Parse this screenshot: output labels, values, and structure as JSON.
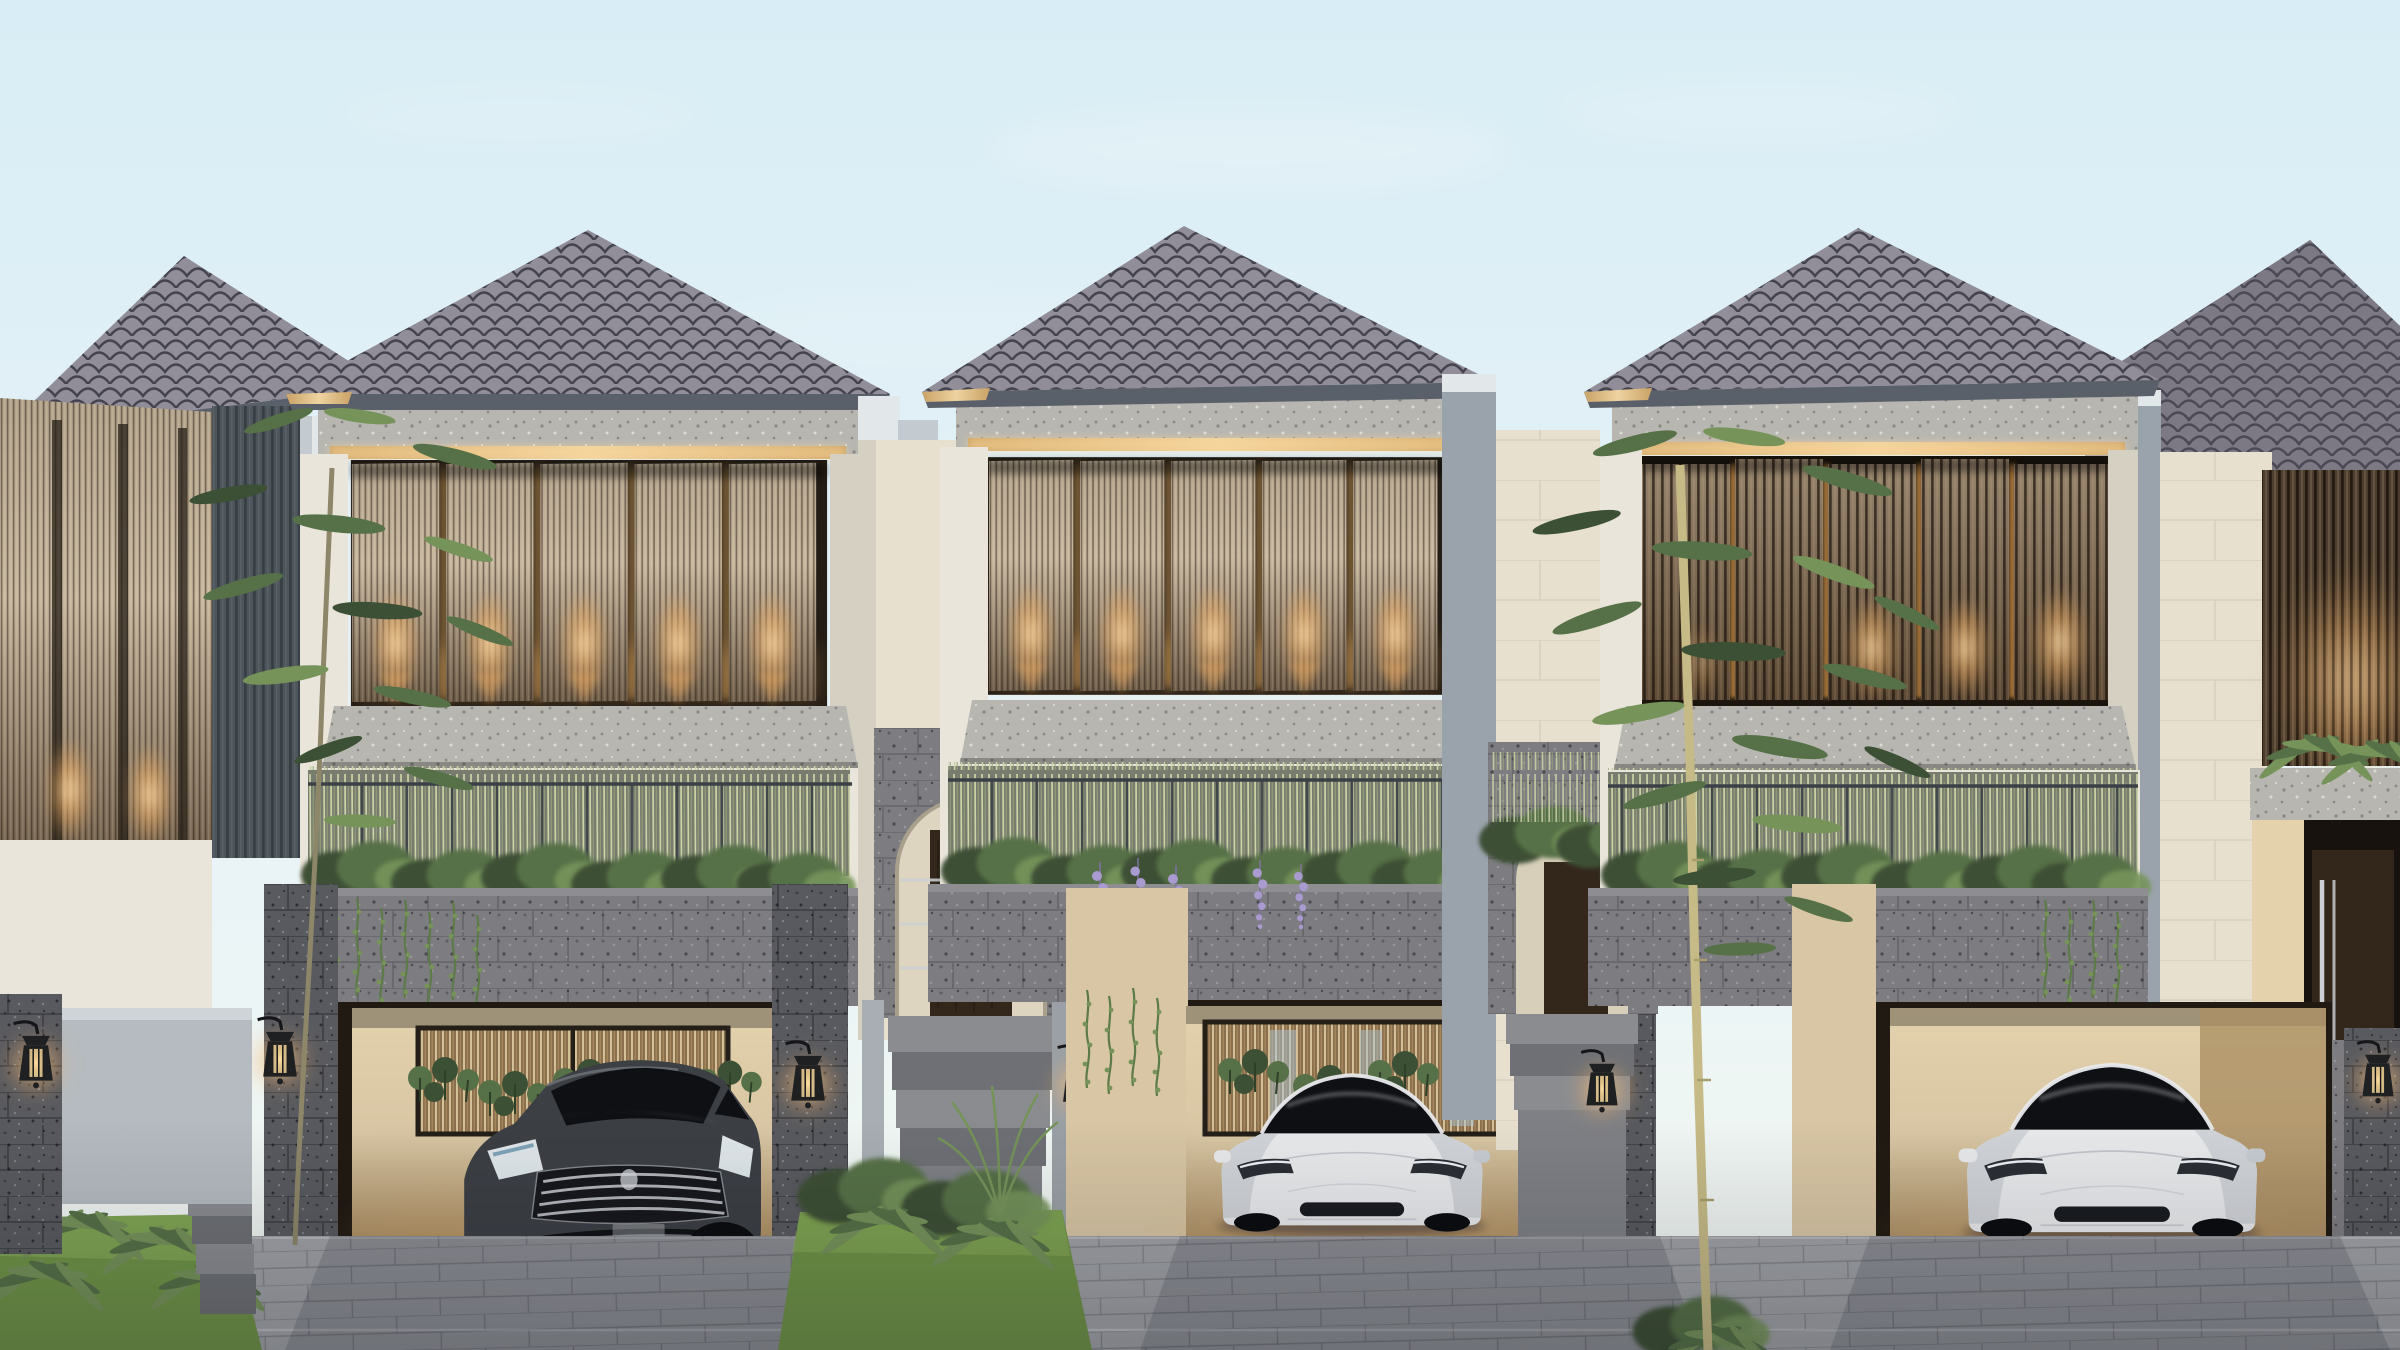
{
  "scene": {
    "medium": "3D architectural exterior rendering",
    "subject": "Row of modern two-storey tropical villas at dusk",
    "time_of_day": "dusk, warm accent lighting on",
    "houses": [
      {
        "id": "far-left",
        "visibility": "partial, clipped at left edge"
      },
      {
        "id": "left",
        "carport_vehicle": "dark gray sedan"
      },
      {
        "id": "middle",
        "carport_vehicle": "white electric sedan"
      },
      {
        "id": "right",
        "carport_vehicle": "white electric sedan"
      },
      {
        "id": "far-right",
        "visibility": "partial, clipped at right edge"
      }
    ],
    "features": [
      "hip roofs with dark scalloped shingles",
      "gold fascia trim and warm LED cove strips",
      "pivoting timber louver screens with downlight glow",
      "granite cornices, sills and planter walls",
      "terrace planters with reeds, ferns and hanging vines",
      "wisteria over the middle carport",
      "arched stone entry portals with timber doors",
      "wall lanterns on stone pillars",
      "interlocking paver driveway",
      "slender ornamental trees",
      "three parked cars"
    ]
  },
  "palette": {
    "sky_top": "#d8edf5",
    "sky_mid": "#e9f4f7",
    "sky_horizon": "#f3f7f1",
    "cloud": "#ffffff",
    "roof_tile": "#918e99",
    "roof_seam": "#45444e",
    "roof_shade": "#7c7987",
    "fascia": "#5a6069",
    "trim_gold": "#c9a266",
    "trim_gold_light": "#eed3a0",
    "led_warm": "#ffd898",
    "stone_light": "#b8b6b1",
    "stone_speck_dark": "#8b8984",
    "stone_speck_light": "#dcdad4",
    "planter_stone": "#7d7c80",
    "planter_speck": "#5e5d61",
    "planter_speck_dk": "#4a494d",
    "planter_speck_lt": "#97969a",
    "pillar_stone": "#595a5f",
    "pillar_speck": "#3f4045",
    "pillar_speck_lt": "#7d7e84",
    "pillar_speck_dk": "#2e2f34",
    "wall_cream": "#e9e5da",
    "wall_cream_shade": "#d5d0c2",
    "wall_stucco": "#9aa3ab",
    "wall_stucco_light": "#e2e7ea",
    "wall_stucco_mid": "#c3cad0",
    "wall_beige": "#e7e0cf",
    "louver_top": "#b4a48d",
    "louver_mid": "#c9b8a0",
    "louver_bottom": "#6f5e4b",
    "louverc_top": "#97846d",
    "louverc_bottom": "#5c4a36",
    "slat_line": "rgba(40,28,16,0.5)",
    "slat_hi": "rgba(255,240,214,0.14)",
    "slatc_line": "rgba(26,17,10,0.7)",
    "slatc_hi": "rgba(240,214,170,0.16)",
    "screen_void": "#241d15",
    "interior_warm": "#c99a58",
    "glow_core": "#ffe3b0",
    "glow_warm": "#f2ae62",
    "glass_dark": "#0e1014",
    "railing": "#3a4046",
    "reed_bg": "#2c3526",
    "reed_light": "#ccd3a6",
    "reed_mid": "#97a47c",
    "plant_dark": "#3c5035",
    "plant_mid": "#567147",
    "plant_light": "#76935a",
    "grass": "#6f9447",
    "grass_light": "#8db25c",
    "vine": "#5d7a49",
    "wisteria": "#a99bd0",
    "carport_wall": "#d8c6a4",
    "carport_wall_dark": "#ad9064",
    "carport_lit": "#e4d2ad",
    "carport_void": "#211a12",
    "curtain_bg": "#8a6f4e",
    "curtain_line": "#e6d3a8",
    "door_wood": "#33271c",
    "steel": "#cdd1d5",
    "paver": "#a0a2a7",
    "paver_line": "#7e8086",
    "car_white": "#e9eaec",
    "car_white_shade": "#c8ccd2",
    "car_dark_body": "#3c3f44",
    "car_dark_hi": "#757a81",
    "wheel": "#0b0c0f",
    "rim": "#686c72",
    "lantern_body": "#1f2022",
    "trunk_left": "#8d8669",
    "trunk_right": "#c6ba86",
    "step_light": "#8a8c90",
    "step_dark": "#6e7075",
    "shadow": "rgba(10,14,20,0.38)"
  }
}
